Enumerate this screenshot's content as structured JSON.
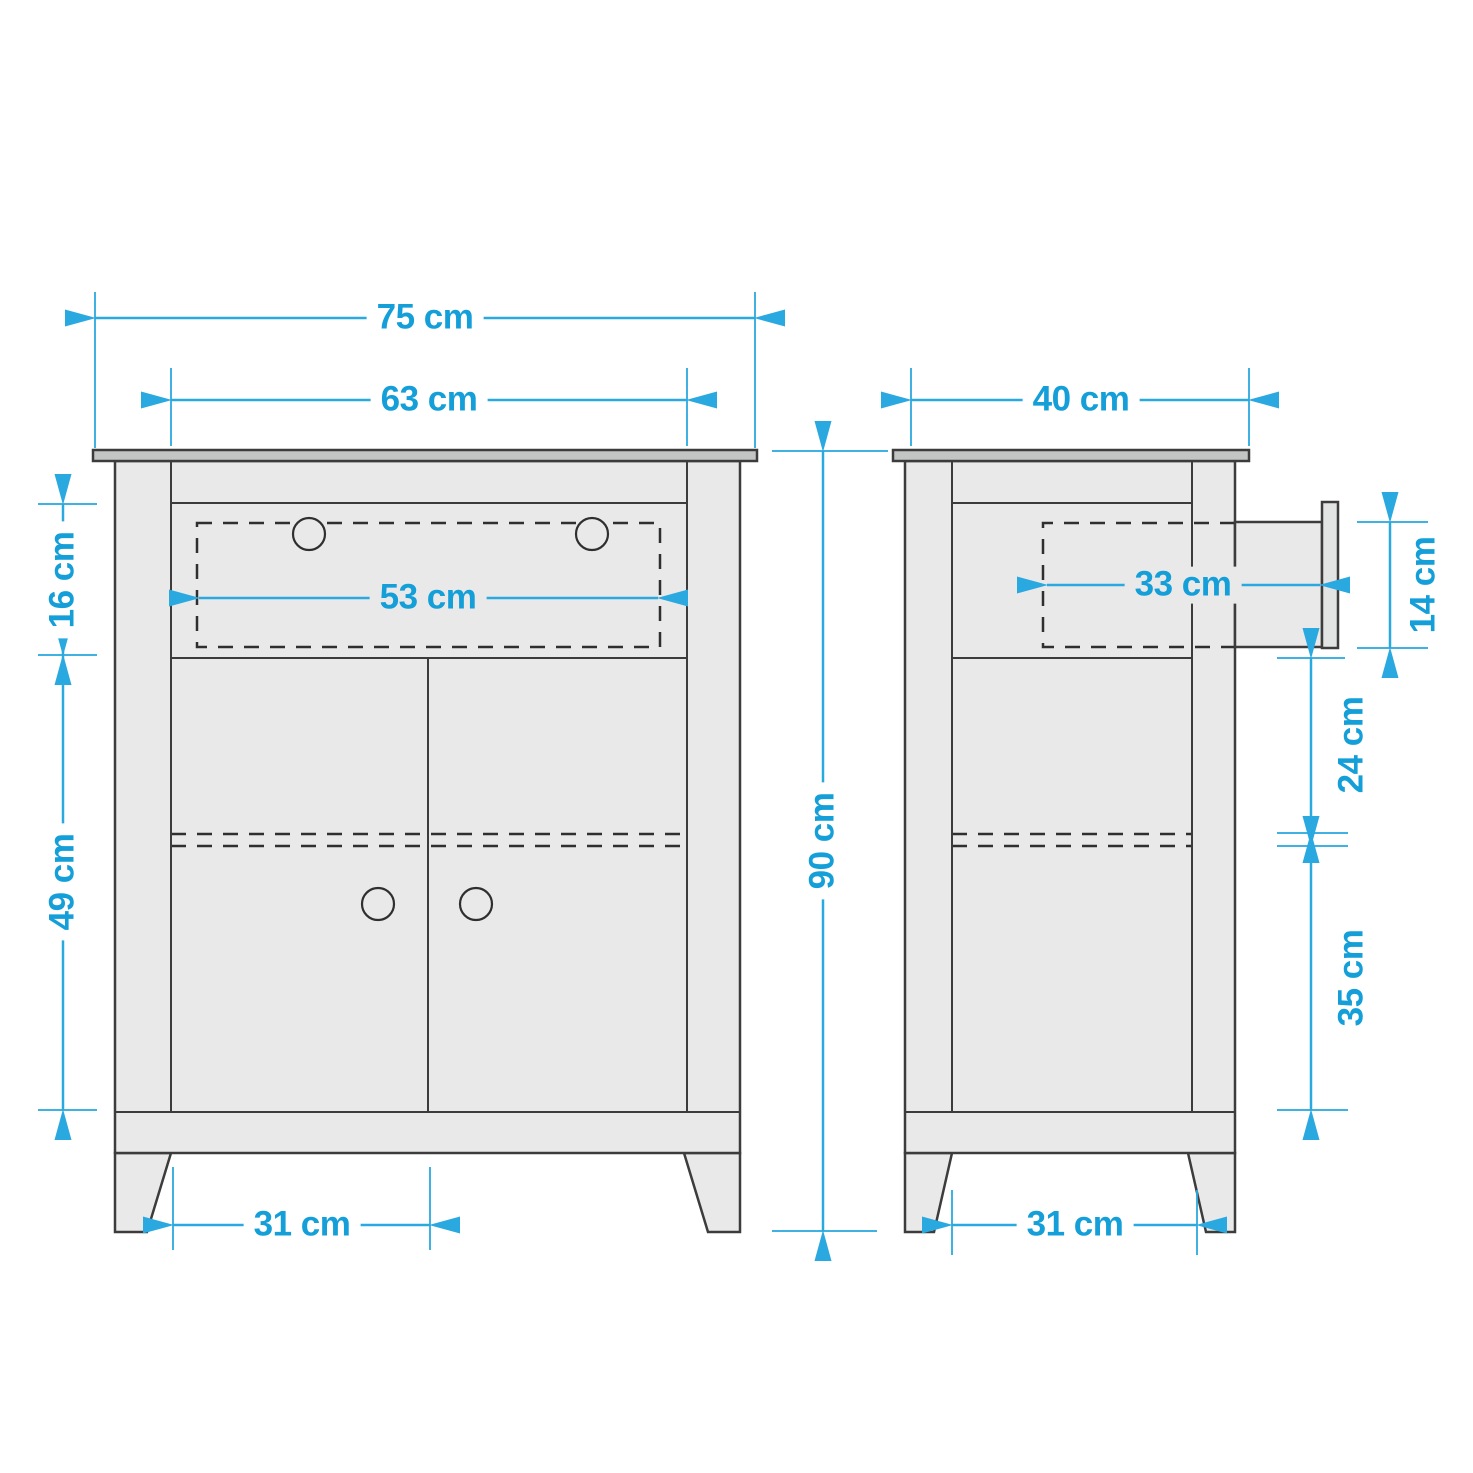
{
  "diagram": {
    "kind": "furniture-dimension-drawing",
    "subject": "cabinet with one drawer and two doors",
    "views": [
      {
        "id": "front",
        "name": "front elevation view"
      },
      {
        "id": "side",
        "name": "side elevation view with drawer pulled out"
      }
    ],
    "units": "cm"
  },
  "colors": {
    "accent": "#2aa9e0",
    "text": "#149fd9",
    "cabinet_fill": "#e9e9e9",
    "top_board_fill": "#c3c5c5",
    "drawer_front_fill": "#e2e3e3",
    "outline": "#3c3c3c",
    "background": "#ffffff"
  },
  "dimensions": {
    "top_width": {
      "label": "75 cm",
      "view": "front",
      "measures": "overall top board width"
    },
    "inner_width": {
      "label": "63 cm",
      "view": "front",
      "measures": "carcass inner width"
    },
    "side_depth": {
      "label": "40 cm",
      "view": "side",
      "measures": "overall depth"
    },
    "drawer_height": {
      "label": "16 cm",
      "view": "front",
      "measures": "drawer section height"
    },
    "drawer_width": {
      "label": "53 cm",
      "view": "front",
      "measures": "drawer inner width"
    },
    "door_height": {
      "label": "49 cm",
      "view": "front",
      "measures": "door section height"
    },
    "total_height": {
      "label": "90 cm",
      "view": "between views",
      "measures": "overall height"
    },
    "drawer_depth": {
      "label": "33 cm",
      "view": "side",
      "measures": "drawer inner depth"
    },
    "drawer_side_height": {
      "label": "14 cm",
      "view": "side",
      "measures": "drawer box height"
    },
    "upper_compartment": {
      "label": "24 cm",
      "view": "side",
      "measures": "space above shelf"
    },
    "lower_compartment": {
      "label": "35 cm",
      "view": "side",
      "measures": "space below shelf"
    },
    "front_leg_span": {
      "label": "31 cm",
      "view": "front",
      "measures": "clearance between legs"
    },
    "side_leg_span": {
      "label": "31 cm",
      "view": "side",
      "measures": "clearance between legs"
    }
  }
}
